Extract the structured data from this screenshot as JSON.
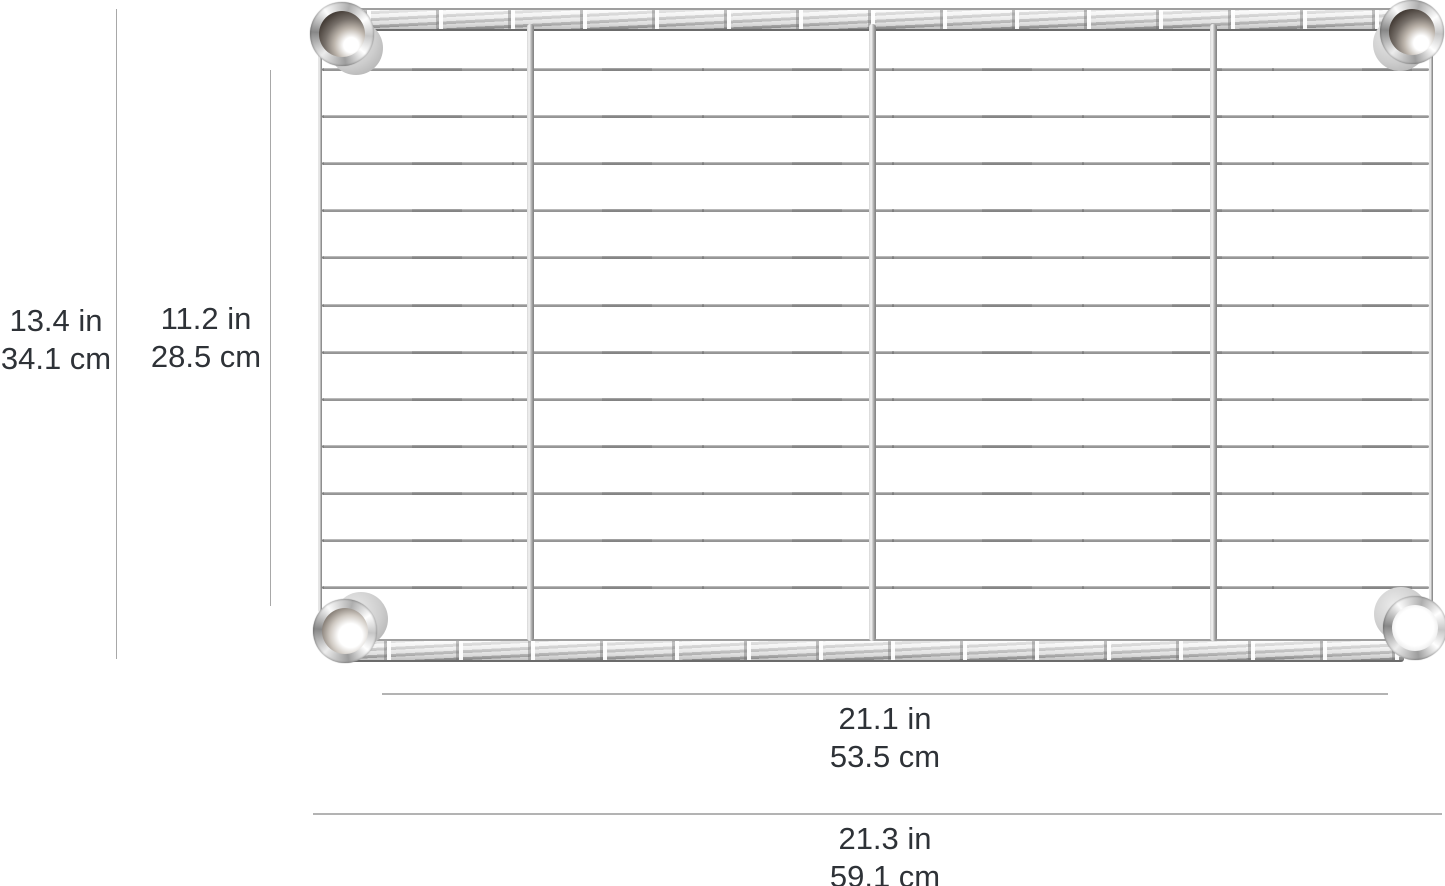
{
  "page": {
    "background": "#ffffff"
  },
  "colors": {
    "label_text": "#2e3237",
    "dimension_line_vertical": "#a8a8a8",
    "dimension_line_horizontal": "#b3b3b3",
    "chrome_light": "#f6f6f6",
    "chrome_mid": "#c2c2c2",
    "chrome_dark": "#6f6f6f"
  },
  "shelf": {
    "kind": "chrome-wire-shelf",
    "horizontal_wires": 12,
    "vertical_support_rails": 3,
    "corner_collars": 4
  },
  "dimensions": {
    "depth_overall": {
      "in": "13.4 in",
      "cm": "34.1 cm"
    },
    "depth_inner": {
      "in": "11.2 in",
      "cm": "28.5 cm"
    },
    "width_inner": {
      "in": "21.1 in",
      "cm": "53.5 cm"
    },
    "width_overall": {
      "in": "21.3 in",
      "cm": "59.1 cm"
    }
  }
}
